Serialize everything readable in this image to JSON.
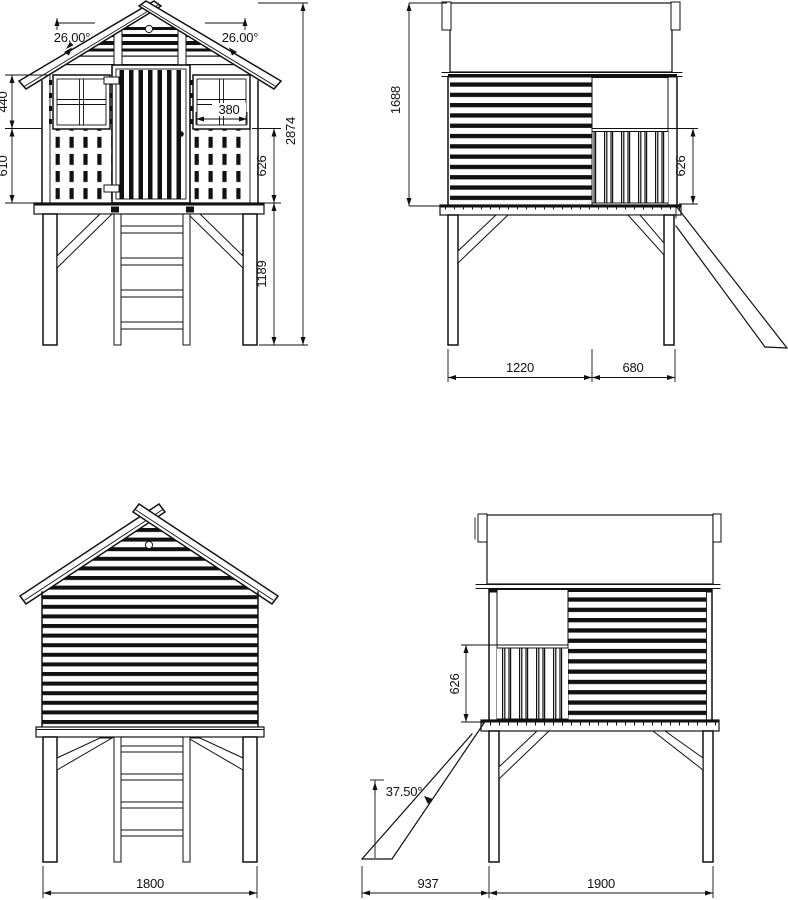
{
  "title": "Playhouse technical drawing - four elevations",
  "colors": {
    "line": "#111111",
    "background": "#ffffff"
  },
  "views": {
    "front": {
      "label": "front-elevation",
      "dims": {
        "roof_angle_left": "26.00°",
        "roof_angle_right": "26.00°",
        "window_band_height": "440",
        "balustrade_band_height": "610",
        "window_width": "380",
        "wall_lower_height": "626",
        "stilt_height": "1189",
        "overall_height": "2874"
      }
    },
    "side_right": {
      "label": "side-elevation-slide-right",
      "dims": {
        "house_height": "1688",
        "railing_height": "626",
        "wall_section_length": "1220",
        "porch_section_length": "680"
      }
    },
    "back": {
      "label": "rear-elevation",
      "dims": {
        "overall_width": "1800"
      }
    },
    "side_left": {
      "label": "side-elevation-slide-left",
      "dims": {
        "railing_height": "626",
        "slide_angle": "37.50°",
        "slide_run": "937",
        "frame_depth": "1900"
      }
    }
  }
}
